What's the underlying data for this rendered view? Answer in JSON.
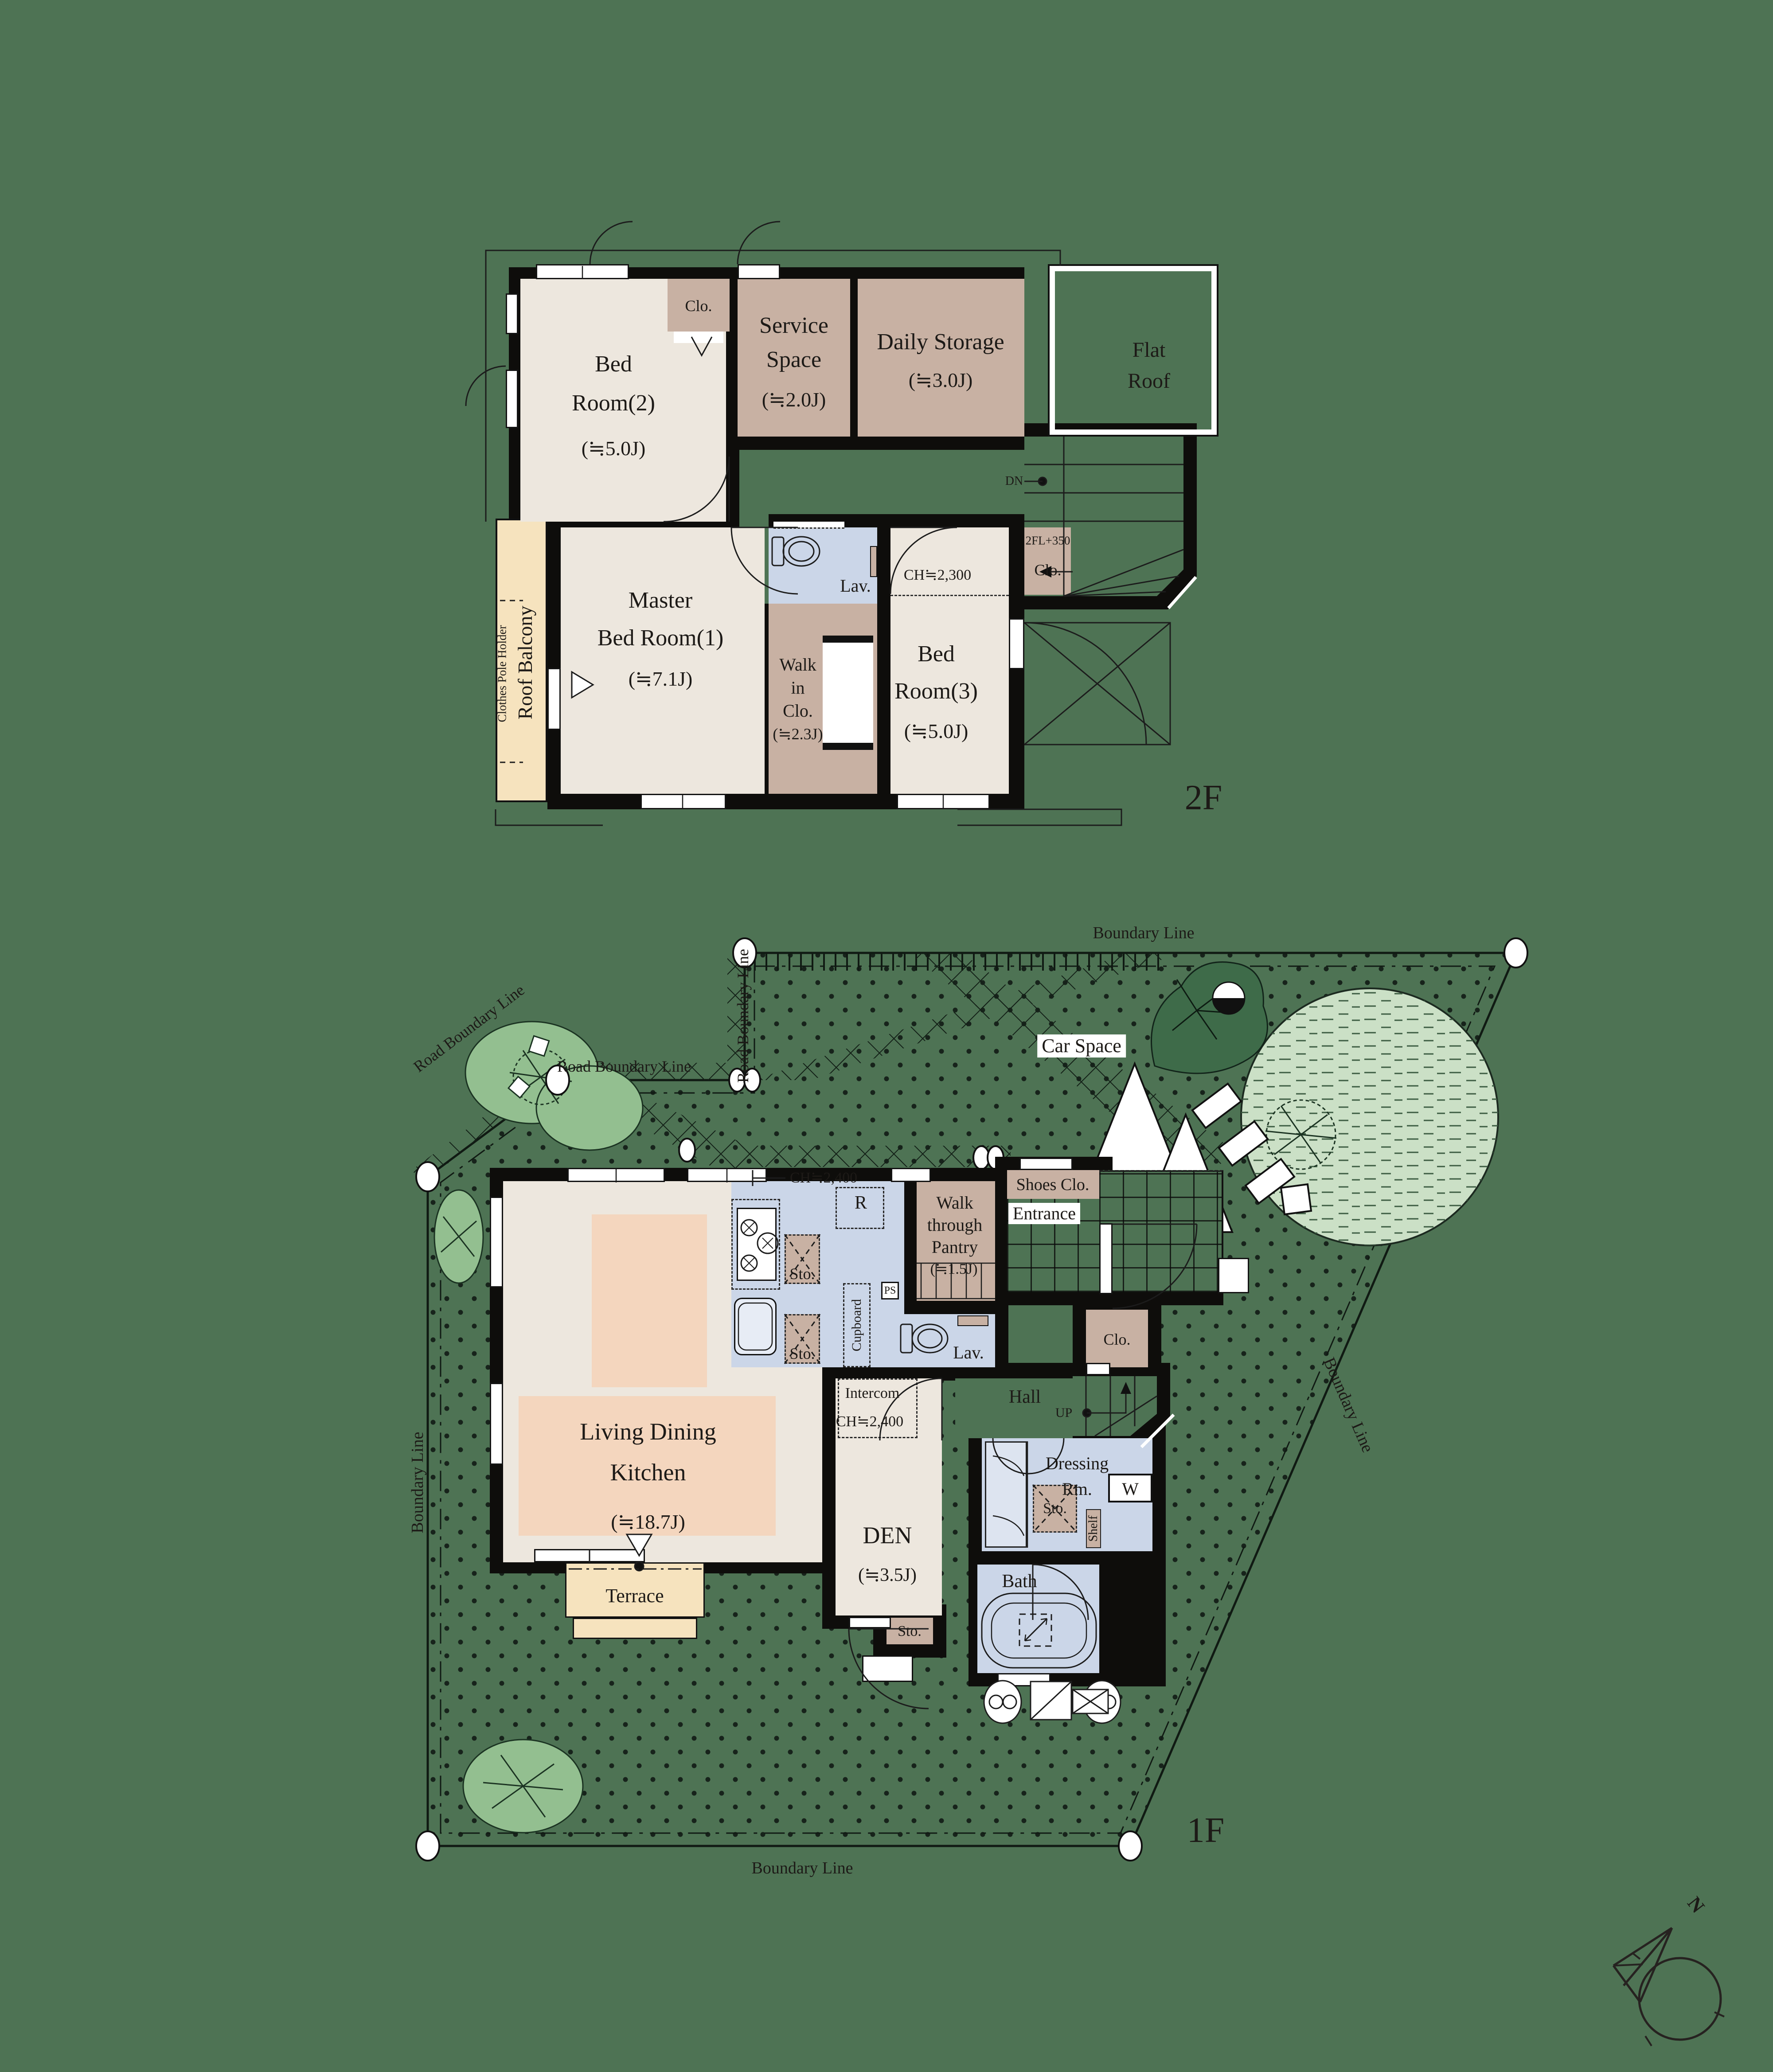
{
  "palette": {
    "background": "#4E7354",
    "floor_beige": "#EDE7DE",
    "storage_tan": "#C8B1A3",
    "water_blue": "#CBD6E8",
    "ldk_peach": "#F4D6BE",
    "terrace_cream": "#F6E3BE",
    "wall_black": "#0e0d0b",
    "shrub_green": "#93BF90",
    "grass_light": "#CBE0C6",
    "line_dark": "#1d1a17"
  },
  "floor2": {
    "label": "2F",
    "bed2": {
      "l1": "Bed",
      "l2": "Room(2)",
      "size": "(≒5.0J)"
    },
    "clo": "Clo.",
    "service": {
      "l1": "Service",
      "l2": "Space",
      "size": "(≒2.0J)"
    },
    "daily": {
      "l1": "Daily Storage",
      "size": "(≒3.0J)"
    },
    "flat_roof": {
      "l1": "Flat",
      "l2": "Roof"
    },
    "dn": "DN",
    "lav": "Lav.",
    "ch": "CH≒2,300",
    "clo_fl": {
      "l1": "2FL+350",
      "l2": "Clo."
    },
    "master": {
      "l1": "Master",
      "l2": "Bed Room(1)",
      "size": "(≒7.1J)"
    },
    "wic": {
      "l1": "Walk",
      "l2": "in",
      "l3": "Clo.",
      "size": "(≒2.3J)"
    },
    "bed3": {
      "l1": "Bed",
      "l2": "Room(3)",
      "size": "(≒5.0J)"
    },
    "balcony": {
      "name": "Roof Balcony",
      "holder": "Clothes Pole Holder"
    }
  },
  "floor1": {
    "label": "1F",
    "boundary": {
      "top": "Boundary Line",
      "right": "Boundary Line",
      "bottom": "Boundary Line",
      "left": "Boundary Line"
    },
    "road": {
      "diag": "Road Boundary Line",
      "horiz": "Road Boundary Line",
      "vert": "Road Boundary Line"
    },
    "car_space": "Car Space",
    "kitchen": {
      "ch": "CH≒2,400",
      "r": "R",
      "sto1": "Sto.",
      "sto2": "Sto.",
      "cupboard": "Cupboard",
      "ps": "PS"
    },
    "pantry": {
      "l1": "Walk",
      "l2": "through",
      "l3": "Pantry",
      "size": "(≒1.5J)"
    },
    "shoes": "Shoes Clo.",
    "entrance": "Entrance",
    "lav": "Lav.",
    "hall": "Hall",
    "up": "UP",
    "clo": "Clo.",
    "intercom": "Intercom",
    "den_ch": "CH≒2,400",
    "ldk": {
      "l1": "Living Dining",
      "l2": "Kitchen",
      "size": "(≒18.7J)"
    },
    "den": {
      "l1": "DEN",
      "size": "(≒3.5J)"
    },
    "dressing": {
      "l1": "Dressing",
      "l2": "Rm.",
      "sto": "Sto.",
      "w": "W",
      "shelf": "Shelf"
    },
    "bath": "Bath",
    "sto": "Sto.",
    "terrace": "Terrace"
  },
  "compass": {
    "n": "N"
  }
}
